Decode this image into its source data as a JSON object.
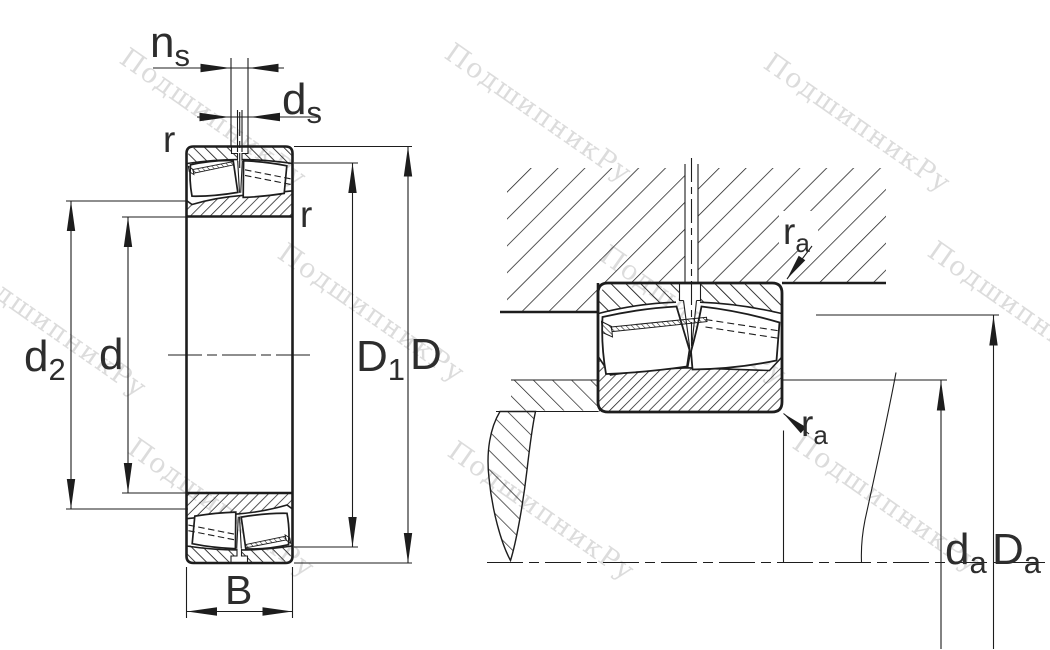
{
  "drawing_type": "bearing technical drawing",
  "watermark": {
    "text": "ПодшипникРу"
  },
  "colors": {
    "line": "#1d1d1d",
    "label": "#2d2d2d",
    "watermark": "#dcdcdc",
    "background": "#ffffff"
  },
  "figures": {
    "sectional_view": {
      "description": "bearing cross-section with boundary dimensions",
      "dimension_labels": {
        "ns": {
          "main": "n",
          "sub": "s"
        },
        "ds": {
          "main": "d",
          "sub": "s"
        },
        "r_top": "r",
        "r_right": "r",
        "d2": {
          "main": "d",
          "sub": "2"
        },
        "d": "d",
        "D1": {
          "main": "D",
          "sub": "1"
        },
        "D": "D",
        "B": "B"
      }
    },
    "mounting_view": {
      "description": "bearing mounted in housing on shaft with abutment dimensions",
      "dimension_labels": {
        "ra_top": {
          "main": "r",
          "sub": "a"
        },
        "ra_bottom": {
          "main": "r",
          "sub": "a"
        },
        "da": {
          "main": "d",
          "sub": "a"
        },
        "Da": {
          "main": "D",
          "sub": "a"
        }
      }
    }
  }
}
